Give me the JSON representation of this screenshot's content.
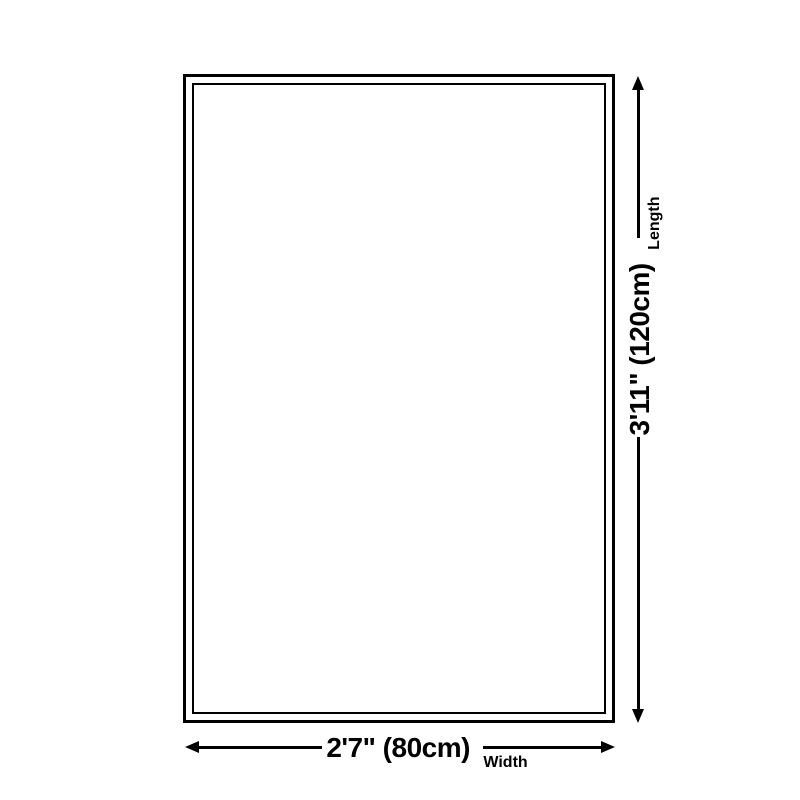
{
  "diagram": {
    "type": "product-dimension-diagram",
    "colors": {
      "background": "#ffffff",
      "line": "#000000",
      "text": "#000000"
    },
    "vertical_dimension": {
      "value": "3'11\" (120cm)",
      "label": "Length"
    },
    "horizontal_dimension": {
      "value": "2'7\" (80cm)",
      "label": "Width"
    }
  }
}
